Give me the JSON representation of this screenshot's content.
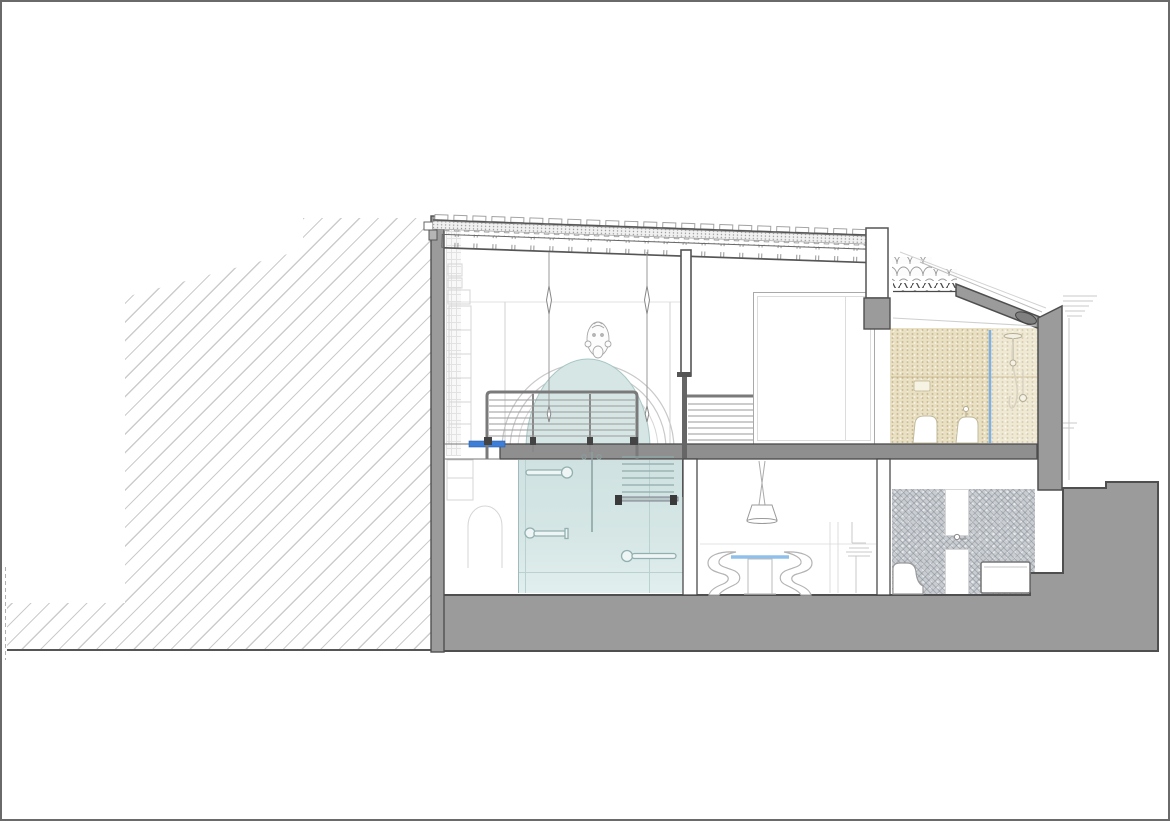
{
  "document": {
    "type": "architectural-section-drawing",
    "title": "Residential building cross-section",
    "sheet": {
      "width_px": 1170,
      "height_px": 821
    }
  },
  "palette": {
    "page_bg": "#ffffff",
    "frame": "#6a6a6a",
    "line_dark": "#4a4a4a",
    "line": "#555555",
    "line_light": "#c9c9c9",
    "hatch": "#cccccc",
    "poche": "#9b9b9b",
    "slab": "#8f8f8f",
    "glass": "#d5e6e5",
    "glass_edge": "#9fbcbb",
    "beige": "#e9dfc2",
    "mosaic": "#c9cdd1",
    "accent_blue": "#3c7ed8",
    "soft_blue": "#8fc0ec",
    "shower_blue": "#7fb0e2",
    "white": "#ffffff"
  },
  "elements": [
    {
      "name": "adjacent-building-hatch",
      "role": "neighbouring structure shown with 45-degree hatch"
    },
    {
      "name": "ground-poche",
      "role": "cut ground / foundation mass"
    },
    {
      "name": "left-wall-poche",
      "role": "cut exterior wall, left"
    },
    {
      "name": "main-roof",
      "role": "tiled roof build-up with joists"
    },
    {
      "name": "secondary-roof-slope",
      "role": "lower pitched tile roof over bathroom"
    },
    {
      "name": "mezzanine-slab",
      "role": "intermediate floor slab"
    },
    {
      "name": "arched-opening",
      "role": "arched glazed opening with keystone mask ornament"
    },
    {
      "name": "cable-railing",
      "role": "mezzanine guardrail with horizontal cables"
    },
    {
      "name": "stair",
      "role": "stair between ground floor and mezzanine"
    },
    {
      "name": "glass-partition",
      "role": "full-height glazed partition with pull handles"
    },
    {
      "name": "pendant-rod-lights",
      "role": "thin pendant lights in double-height space"
    },
    {
      "name": "dining-set",
      "role": "table with blue glass top, two S-chairs, cone pendant"
    },
    {
      "name": "upper-bathroom",
      "role": "beige-tiled bathroom with wc, bidet, shower column"
    },
    {
      "name": "lower-bathroom",
      "role": "mosaic-tiled bathroom with basin niche, tub, wc"
    },
    {
      "name": "wardrobe",
      "role": "built-in wardrobe in bedroom"
    },
    {
      "name": "facade-outline",
      "role": "light outline of facade and cornice beyond the cut"
    }
  ]
}
